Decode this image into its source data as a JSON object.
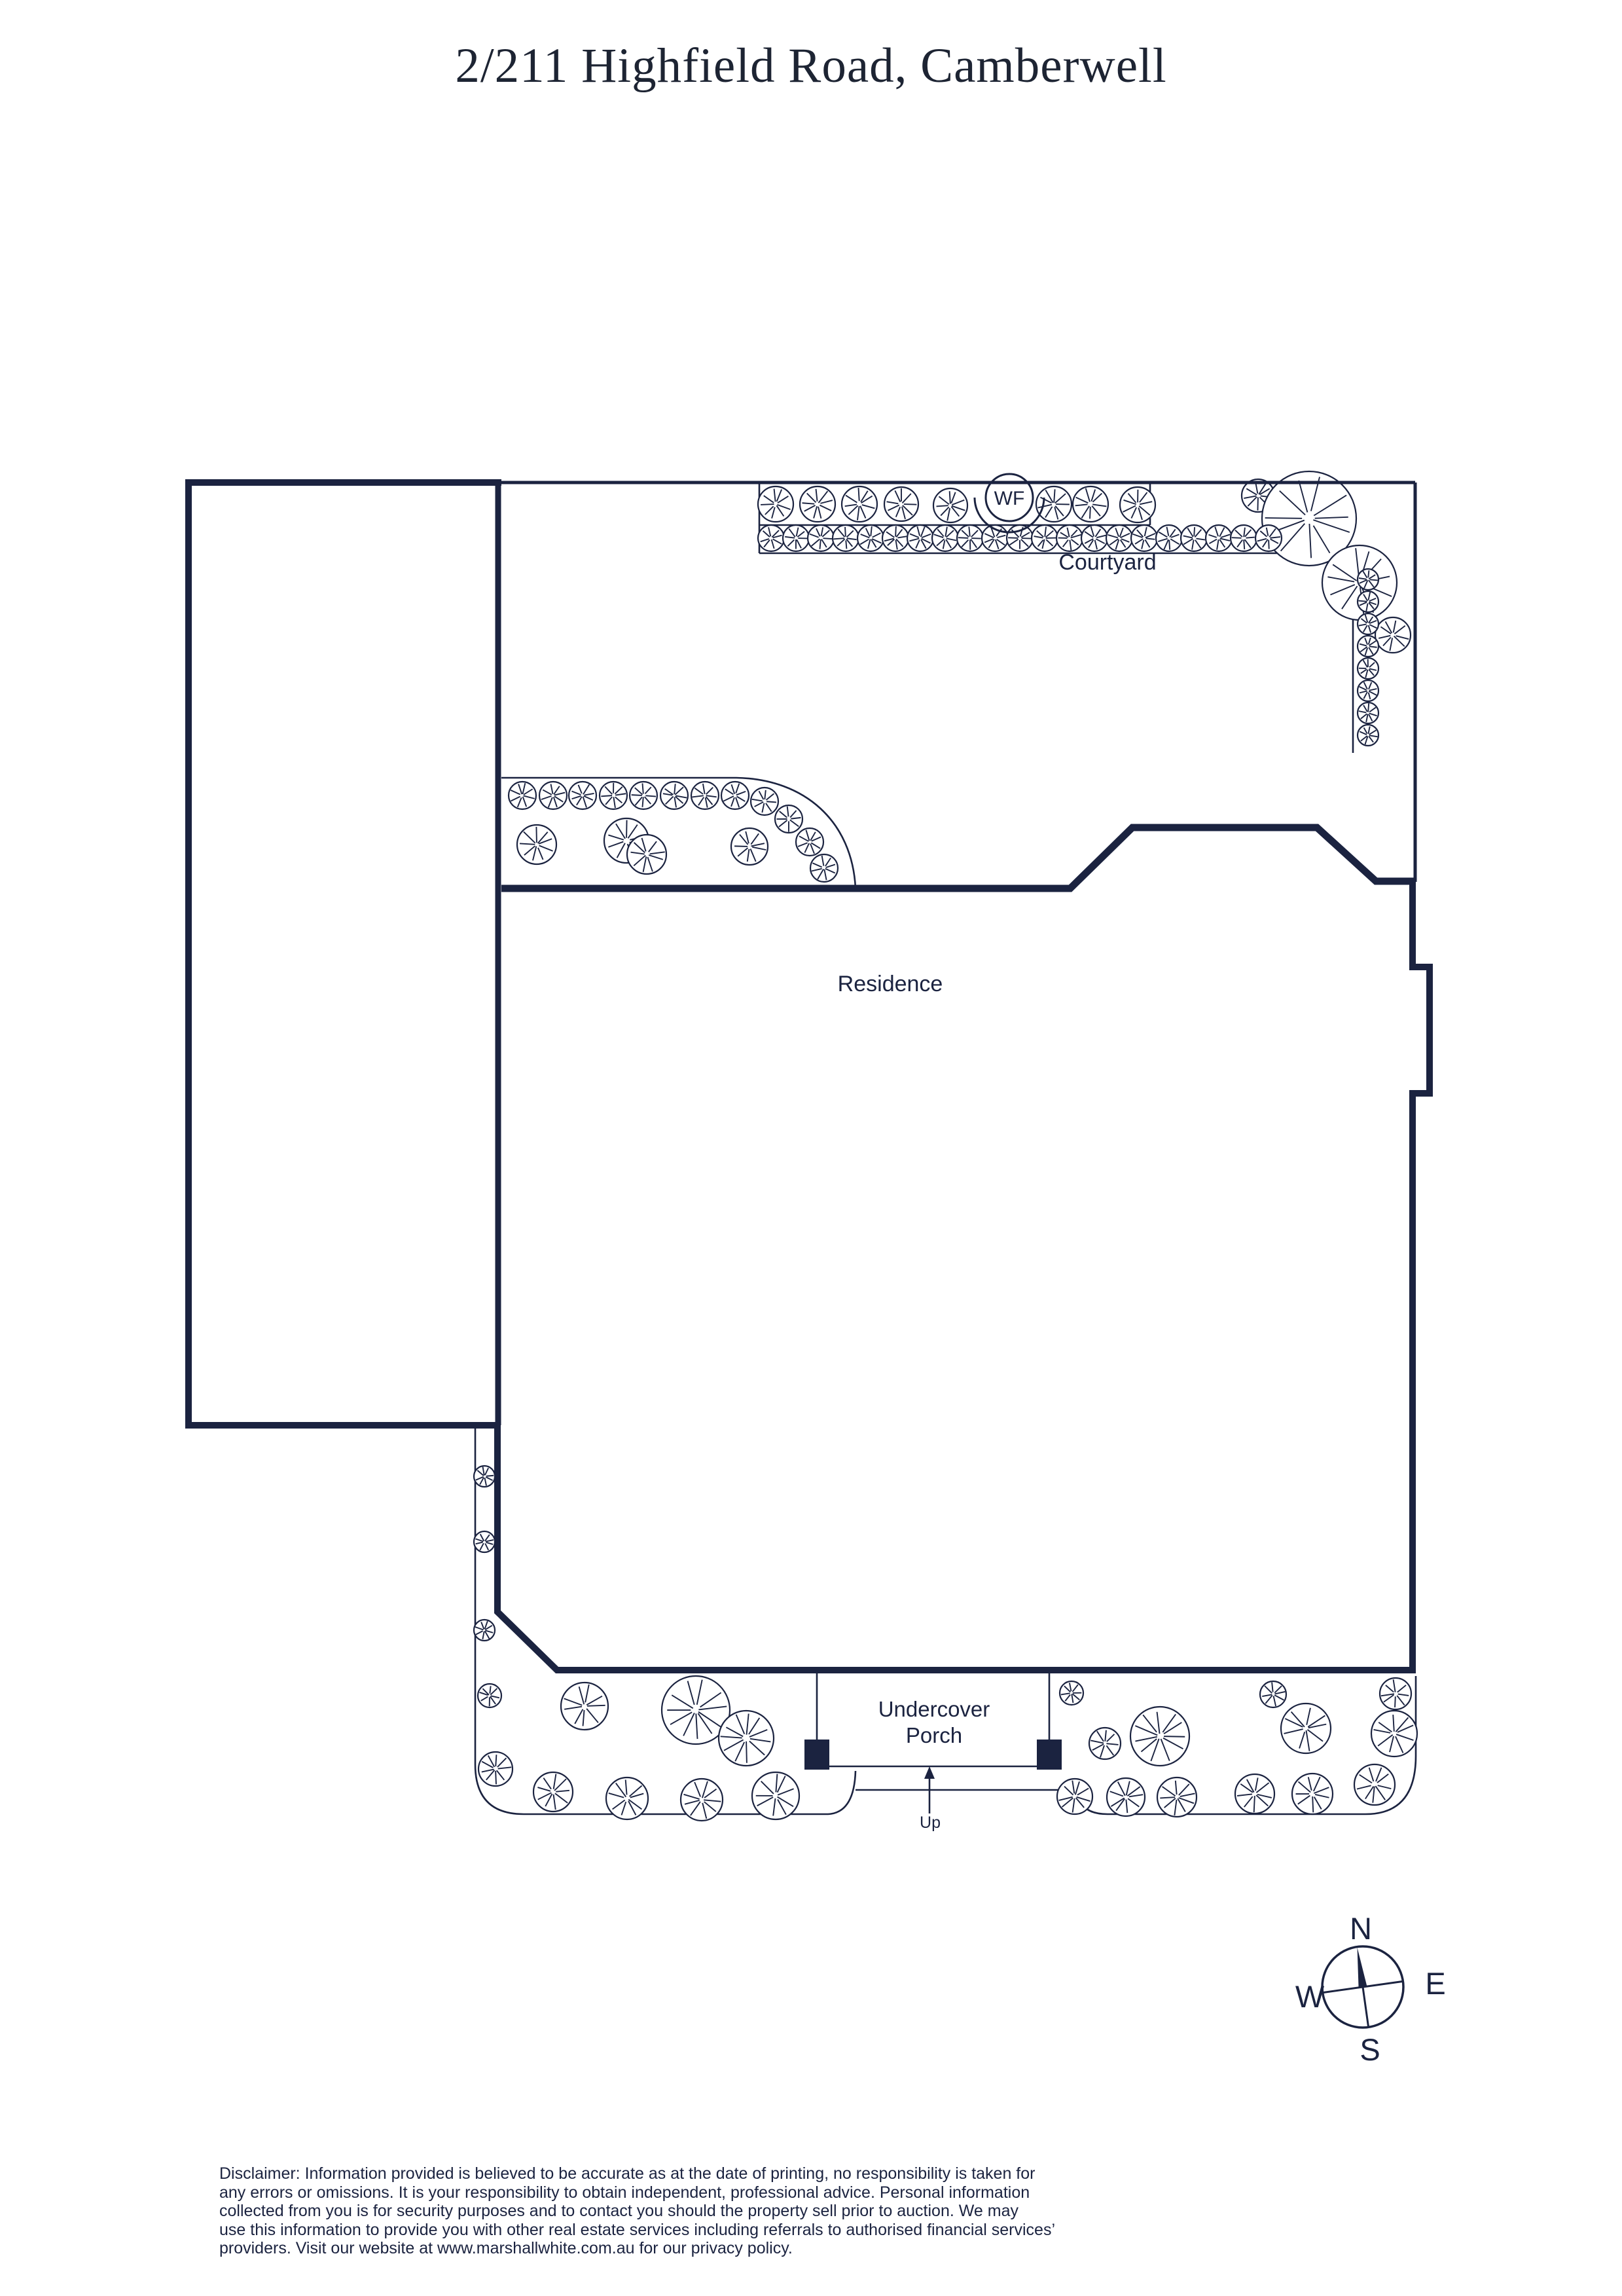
{
  "title": "2/211 Highfield Road, Camberwell",
  "colors": {
    "ink": "#1b2340",
    "title_ink": "#1d2433",
    "background": "#ffffff"
  },
  "plan": {
    "labels": {
      "courtyard": "Courtyard",
      "residence": "Residence",
      "porch_line1": "Undercover",
      "porch_line2": "Porch",
      "up": "Up",
      "water_feature": "WF"
    },
    "compass": {
      "north": "N",
      "east": "E",
      "south": "S",
      "west": "W"
    }
  },
  "disclaimer": {
    "lines": [
      "Disclaimer: Information provided is believed to be accurate as at the date of printing, no responsibility is taken for",
      "any errors or omissions. It is your responsibility to obtain independent, professional advice. Personal information",
      "collected from you is for security purposes and to contact you should the property sell prior to auction. We may",
      "use this information to provide you with other real estate services including referrals to authorised financial services’",
      "providers. Visit our website at www.marshallwhite.com.au for our privacy policy."
    ]
  }
}
